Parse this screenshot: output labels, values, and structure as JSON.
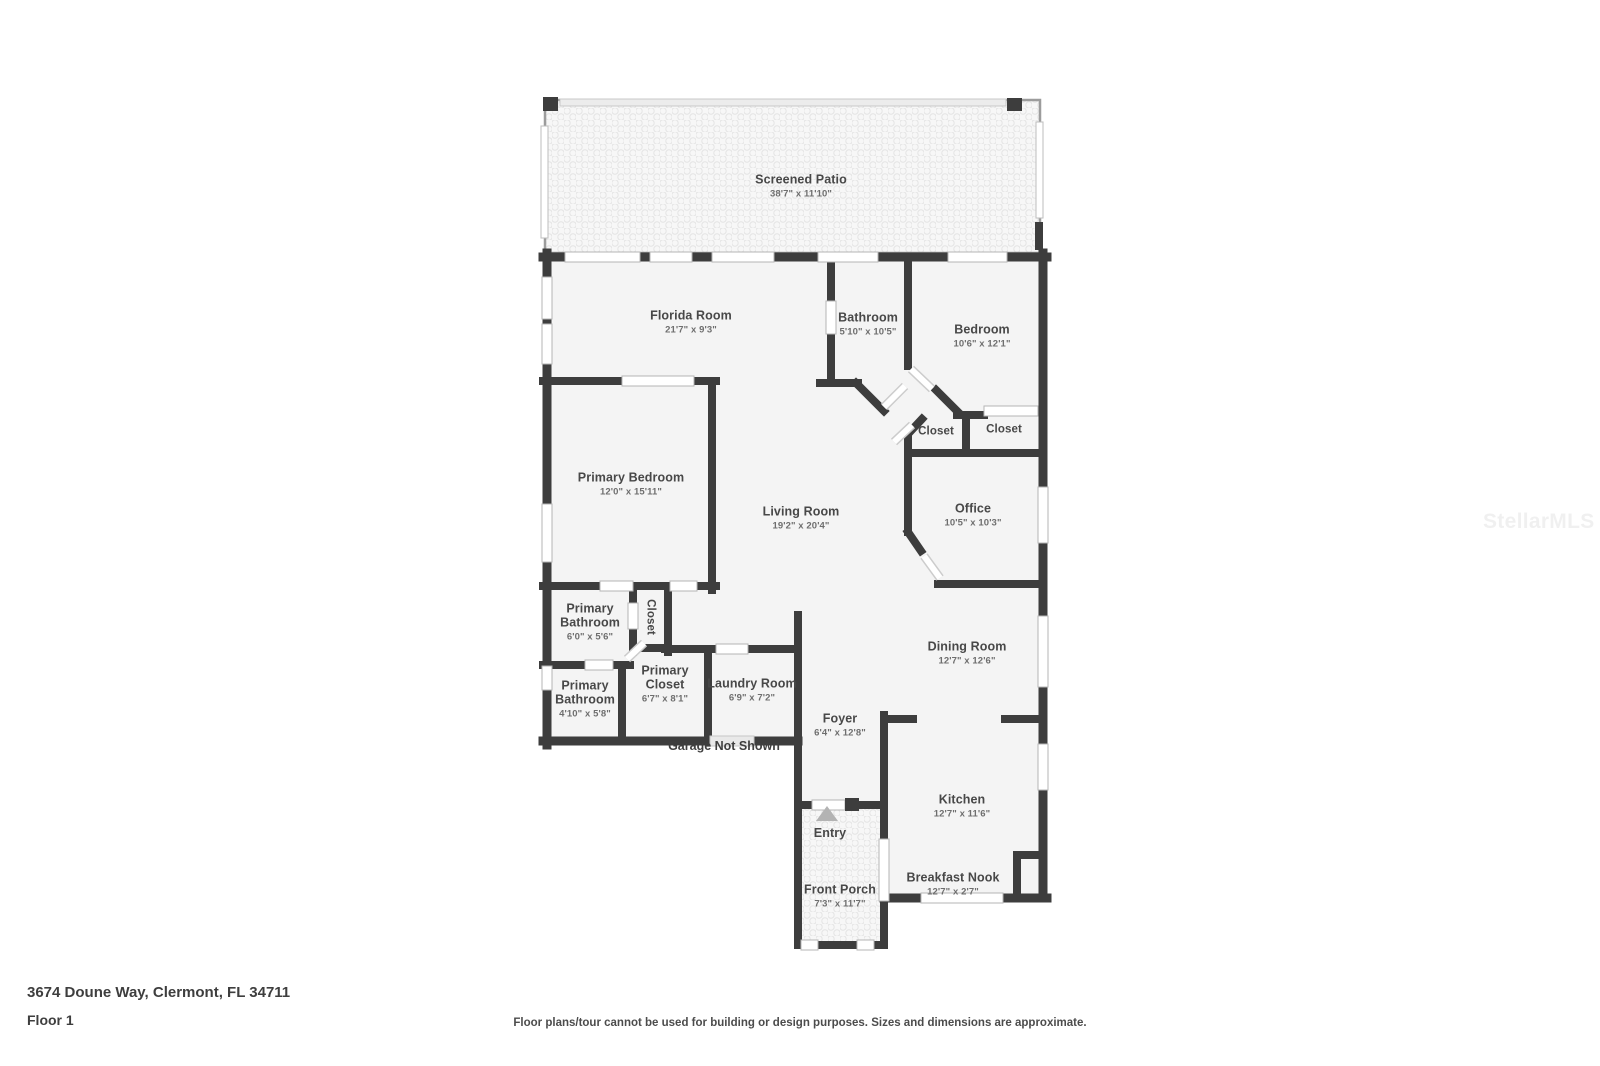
{
  "page": {
    "address": "3674 Doune Way, Clermont, FL 34711",
    "floor_label": "Floor 1",
    "disclaimer": "Floor plans/tour cannot be used for building or design purposes. Sizes and dimensions are approximate.",
    "watermark": "StellarMLS"
  },
  "annotations": {
    "garage_note": "Garage Not Shown",
    "entry": "Entry"
  },
  "rooms": {
    "screened_patio": {
      "name": "Screened Patio",
      "dims": "38'7\" x 11'10\""
    },
    "florida_room": {
      "name": "Florida Room",
      "dims": "21'7\" x 9'3\""
    },
    "bathroom": {
      "name": "Bathroom",
      "dims": "5'10\" x 10'5\""
    },
    "bedroom": {
      "name": "Bedroom",
      "dims": "10'6\" x 12'1\""
    },
    "closet_hall_left": {
      "name": "Closet"
    },
    "closet_hall_right": {
      "name": "Closet"
    },
    "primary_bedroom": {
      "name": "Primary Bedroom",
      "dims": "12'0\" x 15'11\""
    },
    "living_room": {
      "name": "Living Room",
      "dims": "19'2\" x 20'4\""
    },
    "office": {
      "name": "Office",
      "dims": "10'5\" x 10'3\""
    },
    "primary_bathroom_upper": {
      "name": "Primary Bathroom",
      "dims": "6'0\" x 5'6\""
    },
    "closet_primary_hall": {
      "name": "Closet"
    },
    "primary_bathroom_lower": {
      "name": "Primary Bathroom",
      "dims": "4'10\" x 5'8\""
    },
    "primary_closet": {
      "name": "Primary Closet",
      "dims": "6'7\" x 8'1\""
    },
    "laundry_room": {
      "name": "Laundry Room",
      "dims": "6'9\" x 7'2\""
    },
    "dining_room": {
      "name": "Dining Room",
      "dims": "12'7\" x 12'6\""
    },
    "foyer": {
      "name": "Foyer",
      "dims": "6'4\" x 12'8\""
    },
    "kitchen": {
      "name": "Kitchen",
      "dims": "12'7\" x 11'6\""
    },
    "breakfast_nook": {
      "name": "Breakfast Nook",
      "dims": "12'7\" x 2'7\""
    },
    "front_porch": {
      "name": "Front Porch",
      "dims": "7'3\" x 11'7\""
    }
  },
  "colors": {
    "wall": "#3d3d3d",
    "room_fill": "#f4f4f4",
    "window_trim": "#b5b5b5",
    "label_text": "#484848",
    "dims_text": "#6e6e6e"
  }
}
